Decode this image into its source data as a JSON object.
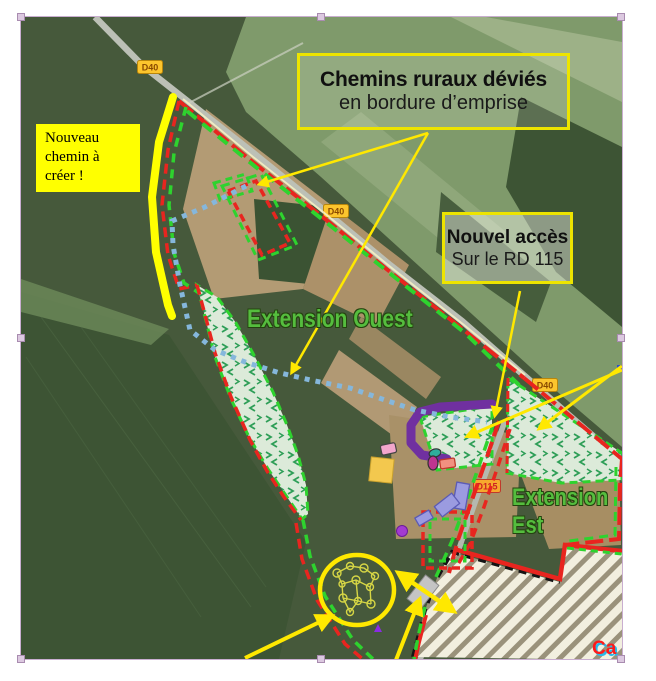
{
  "map": {
    "road_badges": [
      {
        "id": "d40-north",
        "label": "D40"
      },
      {
        "id": "d40-mid",
        "label": "D40"
      },
      {
        "id": "d40-east",
        "label": "D40"
      },
      {
        "id": "d115",
        "label": "D115"
      }
    ],
    "labels": {
      "new_path_note_line1": "Nouveau",
      "new_path_note_line2": "chemin à",
      "new_path_note_line3": "créer !",
      "rural_paths_title": "Chemins ruraux déviés",
      "rural_paths_subtitle": "en bordure d’emprise",
      "new_access_title": "Nouvel accès",
      "new_access_subtitle": "Sur le RD 115",
      "extension_west": "Extension Ouest",
      "extension_east_line1": "Extension",
      "extension_east_line2": "Est",
      "quarry_label_clipped": "Ca"
    },
    "colors": {
      "boundary_red": "#e8251f",
      "boundary_green": "#2ed32e",
      "annotation_yellow": "#ffe800",
      "highlight_yellow": "#ffff00",
      "diverted_path_blue": "#85b7dc",
      "new_access_purple": "#7030a0",
      "extension_zone_fill": "#dcead9",
      "extension_zone_mark": "#2e9e57",
      "quarry_fill": "#f2efdf",
      "quarry_stripe": "#9a927b"
    }
  }
}
